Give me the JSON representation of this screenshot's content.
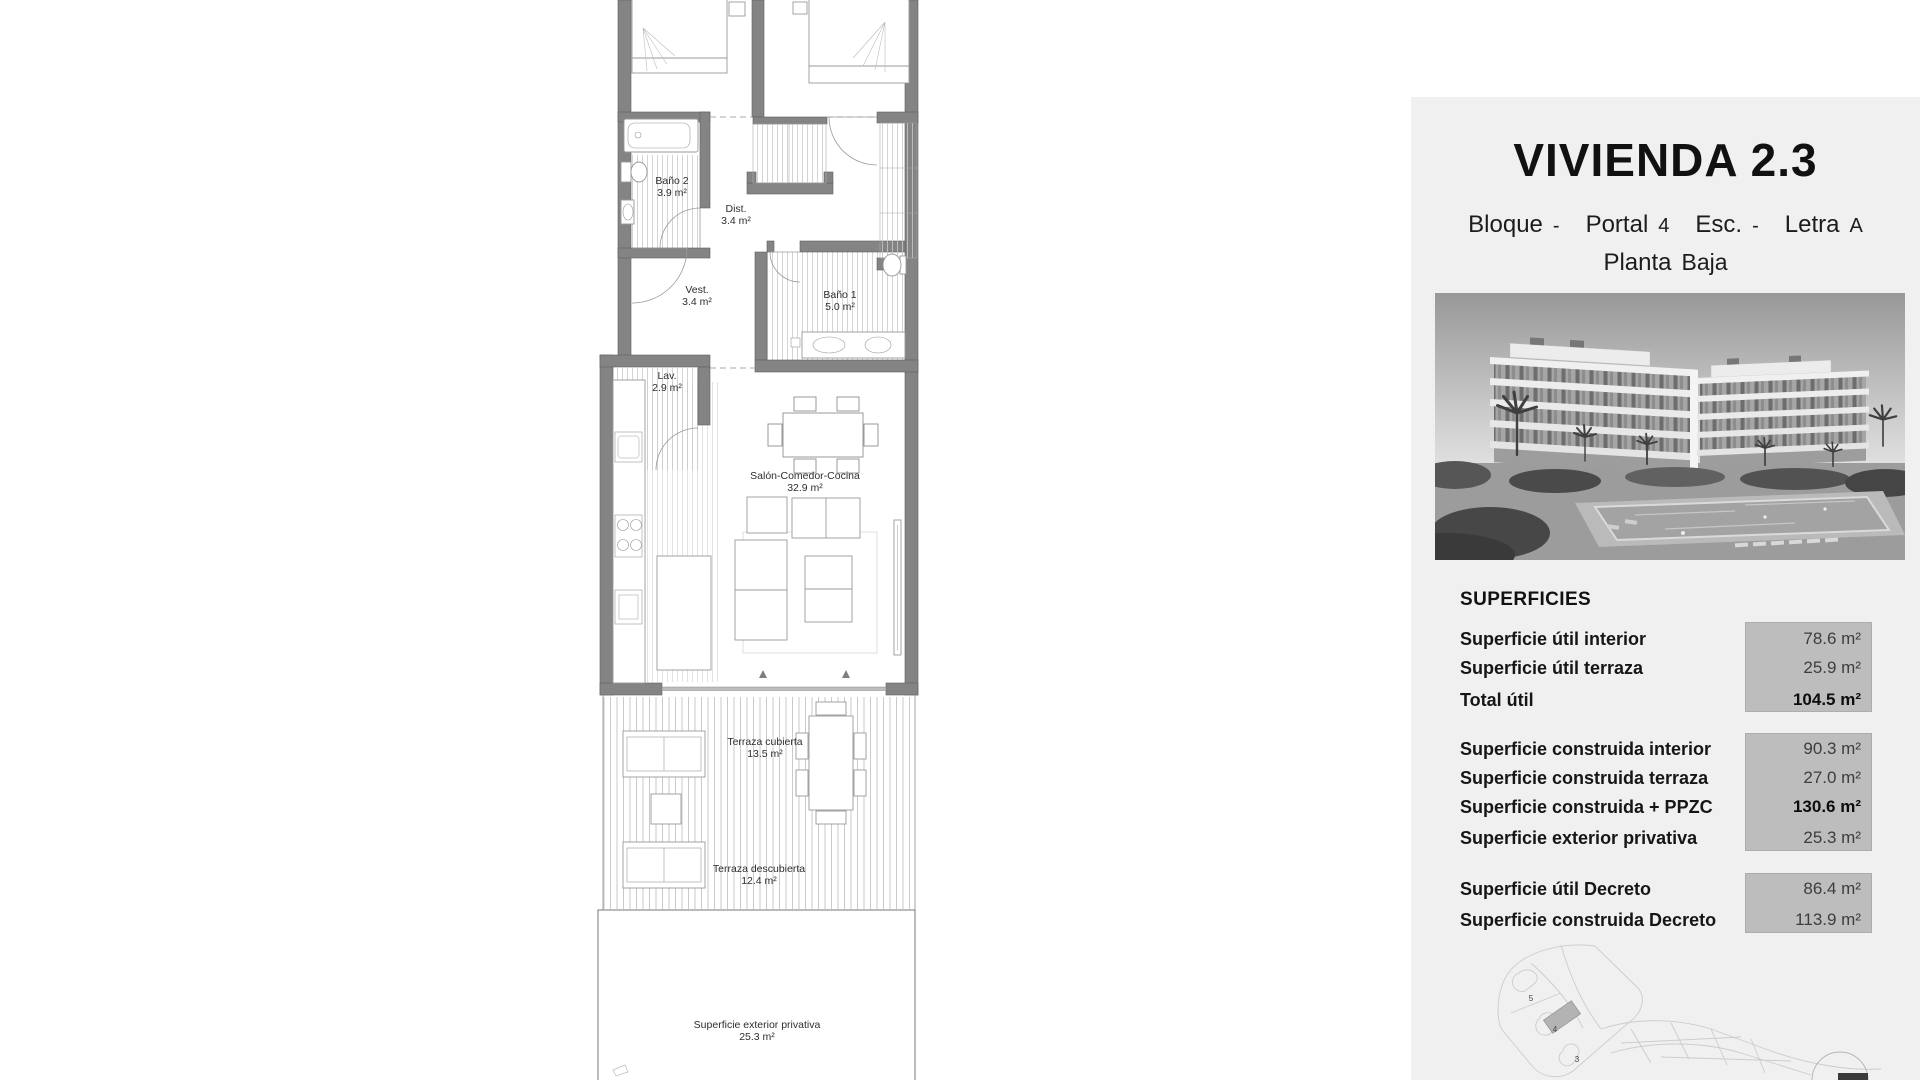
{
  "floor_plan": {
    "rooms": [
      {
        "name": "Baño 2",
        "area": "3.9 m²"
      },
      {
        "name": "Dist.",
        "area": "3.4 m²"
      },
      {
        "name": "Vest.",
        "area": "3.4 m²"
      },
      {
        "name": "Baño 1",
        "area": "5.0 m²"
      },
      {
        "name": "Lav.",
        "area": "2.9 m²"
      },
      {
        "name": "Salón-Comedor-Cocina",
        "area": "32.9 m²"
      },
      {
        "name": "Terraza cubierta",
        "area": "13.5 m²"
      },
      {
        "name": "Terraza descubierta",
        "area": "12.4 m²"
      },
      {
        "name": "Superficie exterior privativa",
        "area": "25.3 m²"
      }
    ],
    "wall_color": "#848484",
    "hatch_color": "#c9c9c9"
  },
  "panel": {
    "title": "VIVIENDA 2.3",
    "location": {
      "bloque_label": "Bloque",
      "bloque": "-",
      "portal_label": "Portal",
      "portal": "4",
      "esc_label": "Esc.",
      "esc": "-",
      "letra_label": "Letra",
      "letra": "A",
      "planta_label": "Planta",
      "planta": "Baja"
    },
    "superficies": {
      "heading": "SUPERFICIES",
      "groups": [
        {
          "rows": [
            {
              "label": "Superficie útil interior",
              "value": "78.6 m²"
            },
            {
              "label": "Superficie útil terraza",
              "value": "25.9 m²"
            },
            {
              "label": "Total útil",
              "value": "104.5 m²"
            }
          ]
        },
        {
          "rows": [
            {
              "label": "Superficie construida interior",
              "value": "90.3 m²"
            },
            {
              "label": "Superficie construida terraza",
              "value": "27.0 m²"
            },
            {
              "label": "Superficie construida + PPZC",
              "value": "130.6 m²"
            },
            {
              "label": "Superficie exterior privativa",
              "value": "25.3 m²"
            }
          ]
        },
        {
          "rows": [
            {
              "label": "Superficie útil Decreto",
              "value": "86.4 m²"
            },
            {
              "label": "Superficie construida Decreto",
              "value": "113.9 m²"
            }
          ]
        }
      ]
    },
    "site_plan": {
      "block_labels": [
        "5",
        "4",
        "3"
      ]
    },
    "colors": {
      "panel_bg": "#f0f0f0",
      "value_box": "#bdbdbd",
      "highlight_block": "#b3b3b3"
    }
  }
}
